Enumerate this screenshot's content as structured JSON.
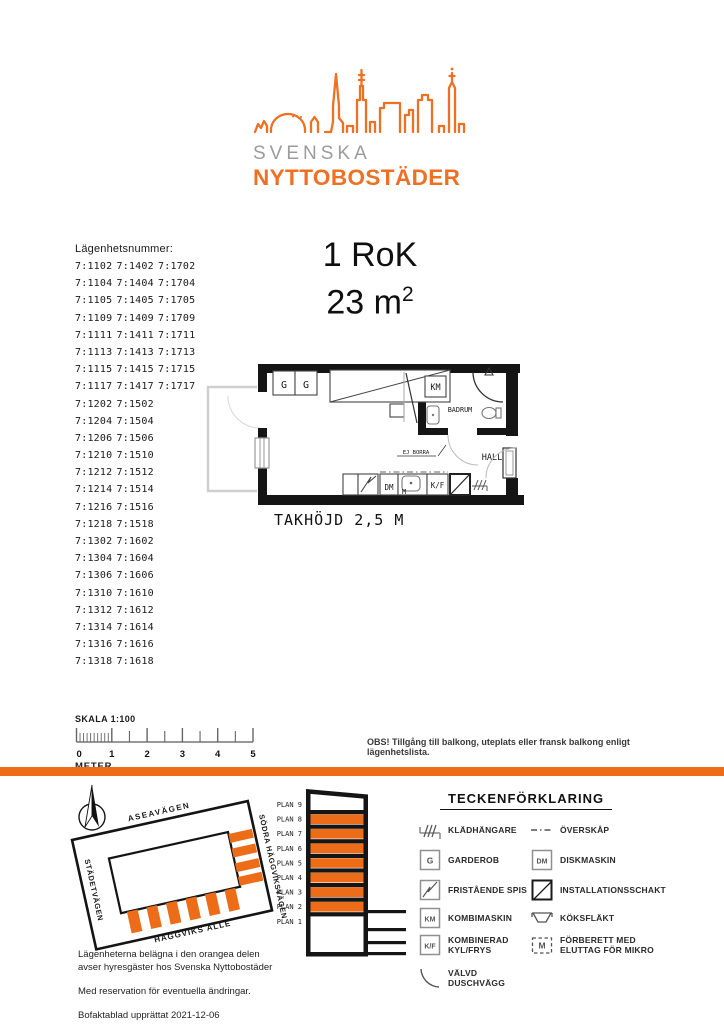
{
  "colors": {
    "accent": "#ED6C17",
    "logo_orange": "#EF7023",
    "logo_gray": "#9C9C9C"
  },
  "logo": {
    "line1": "SVENSKA",
    "line2": "NYTTOBOSTÄDER"
  },
  "apartment_list": {
    "heading": "Lägenhetsnummer:",
    "rows": [
      [
        "7:1102",
        "7:1402",
        "7:1702"
      ],
      [
        "7:1104",
        "7:1404",
        "7:1704"
      ],
      [
        "7:1105",
        "7:1405",
        "7:1705"
      ],
      [
        "7:1109",
        "7:1409",
        "7:1709"
      ],
      [
        "7:1111",
        "7:1411",
        "7:1711"
      ],
      [
        "7:1113",
        "7:1413",
        "7:1713"
      ],
      [
        "7:1115",
        "7:1415",
        "7:1715"
      ],
      [
        "7:1117",
        "7:1417",
        "7:1717"
      ],
      [
        "7:1202",
        "7:1502"
      ],
      [
        "7:1204",
        "7:1504"
      ],
      [
        "7:1206",
        "7:1506"
      ],
      [
        "7:1210",
        "7:1510"
      ],
      [
        "7:1212",
        "7:1512"
      ],
      [
        "7:1214",
        "7:1514"
      ],
      [
        "7:1216",
        "7:1516"
      ],
      [
        "7:1218",
        "7:1518"
      ],
      [
        "7:1302",
        "7:1602"
      ],
      [
        "7:1304",
        "7:1604"
      ],
      [
        "7:1306",
        "7:1606"
      ],
      [
        "7:1310",
        "7:1610"
      ],
      [
        "7:1312",
        "7:1612"
      ],
      [
        "7:1314",
        "7:1614"
      ],
      [
        "7:1316",
        "7:1616"
      ],
      [
        "7:1318",
        "7:1618"
      ]
    ]
  },
  "unit": {
    "rooms": "1 RoK",
    "area": "23 m",
    "area_sup": "2"
  },
  "floorplan": {
    "labels": {
      "g": "G",
      "km": "KM",
      "badrum": "BADRUM",
      "hall": "HALL",
      "dm": "DM",
      "m": "M",
      "kf": "K/F",
      "ej_borra": "EJ BORRA"
    },
    "ceiling_note": "TAKHÖJD 2,5 M"
  },
  "scalebar": {
    "title": "SKALA 1:100",
    "unit": "METER",
    "ticks": [
      "0",
      "1",
      "2",
      "3",
      "4",
      "5"
    ]
  },
  "note": "OBS! Tillgång till balkong, uteplats eller fransk balkong enligt lägenhetslista.",
  "sitemap": {
    "streets": {
      "top": "ASEAVÄGEN",
      "right": "SÖDRA HÄGGVIKSVÄGEN",
      "left": "STÄDETVÄGEN",
      "bottom": "HÄGGVIKS ALLÉ"
    }
  },
  "elevation": {
    "floors": [
      {
        "label": "PLAN 9",
        "orange": false
      },
      {
        "label": "PLAN 8",
        "orange": true
      },
      {
        "label": "PLAN 7",
        "orange": true
      },
      {
        "label": "PLAN 6",
        "orange": true
      },
      {
        "label": "PLAN 5",
        "orange": true
      },
      {
        "label": "PLAN 4",
        "orange": true
      },
      {
        "label": "PLAN 3",
        "orange": true
      },
      {
        "label": "PLAN 2",
        "orange": true
      },
      {
        "label": "PLAN 1",
        "orange": false
      }
    ]
  },
  "legend": {
    "title": "TECKENFÖRKLARING",
    "items": [
      {
        "symbol": "hanger",
        "label": "KLÄDHÄNGARE",
        "col": 1
      },
      {
        "symbol": "box",
        "glyph": "G",
        "label": "GARDEROB",
        "col": 1
      },
      {
        "symbol": "box-zigzag",
        "label": "FRISTÅENDE SPIS",
        "col": 1
      },
      {
        "symbol": "box",
        "glyph": "KM",
        "label": "KOMBIMASKIN",
        "col": 1
      },
      {
        "symbol": "box",
        "glyph": "K/F",
        "label": "KOMBINERAD\nKYL/FRYS",
        "col": 1
      },
      {
        "symbol": "arc",
        "label": "VÄLVD DUSCHVÄGG",
        "col": 1
      },
      {
        "symbol": "dashdot",
        "label": "ÖVERSKÅP",
        "col": 2
      },
      {
        "symbol": "box",
        "glyph": "DM",
        "label": "DISKMASKIN",
        "col": 2
      },
      {
        "symbol": "box-diagonal",
        "label": "INSTALLATIONSSCHAKT",
        "col": 2
      },
      {
        "symbol": "hood",
        "label": "KÖKSFLÄKT",
        "col": 2
      },
      {
        "symbol": "box-m-dashed",
        "glyph": "M",
        "label": "FÖRBERETT MED\nELUTTAG FÖR MIKRO",
        "col": 2
      }
    ]
  },
  "footer": {
    "note1": "Lägenheterna belägna i den orangea delen\navser hyresgäster hos Svenska Nyttobostäder",
    "note2": "Med reservation för eventuella ändringar.",
    "note3": "Bofaktablad upprättat 2021-12-06"
  }
}
